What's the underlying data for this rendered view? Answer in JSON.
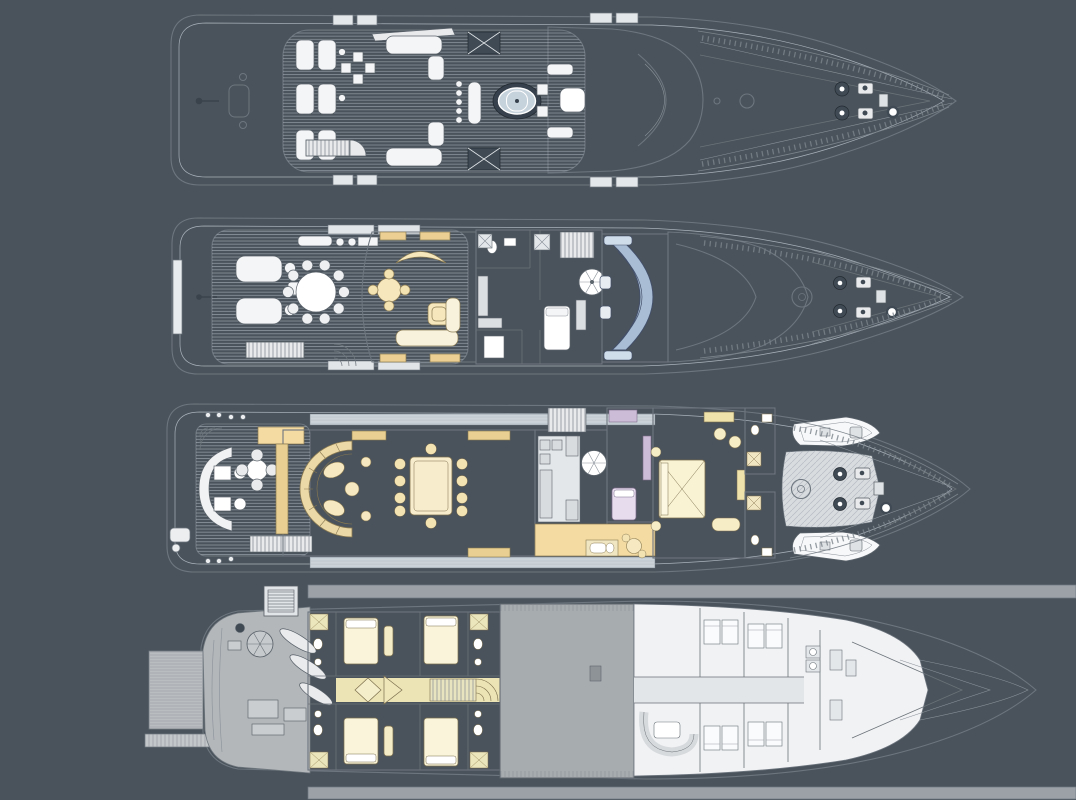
{
  "title": "yacht-general-arrangement-plans",
  "colors": {
    "background": "#4a525b",
    "outline": "#6d757e",
    "hull_white": "#fbfbfc",
    "teak_deck": "#ccd4da",
    "structure_gray": "#d9e0e6",
    "cream_deck": "#eae5d1",
    "salon_tan": "#f4dba2",
    "tan_dark": "#e9cf92",
    "cabin_yellow": "#f2ecc4",
    "master_yellow": "#f4eec2",
    "study_lavender": "#d8c9e1",
    "bridge_blue": "#bcd1e3",
    "console_blue": "#a9bed4",
    "spa_rim": "#36414d",
    "spa_water": "#c7d3dc",
    "engine_gray": "#a7acaf",
    "garage_gray": "#b3b7ba",
    "platform_gray": "#b9bdc0",
    "room_white": "#eef0f2",
    "furniture_white": "#f4f5f6",
    "equipment_dark": "#3f4a55"
  },
  "decks": [
    {
      "id": "sun-deck",
      "order": 1,
      "features": [
        "flag-staff",
        "deck-hatch",
        "sun-loungers",
        "occasional-tables",
        "crane-arm",
        "lounge-sofas",
        "mast-arch",
        "bar-counter",
        "bar-stools",
        "spa-pool",
        "aft-stairs",
        "forward-seating",
        "windscreen",
        "life-raft-boxes",
        "bow-capstan",
        "anchor-windlass",
        "mooring-cleats",
        "bow-rails"
      ]
    },
    {
      "id": "bridge-deck",
      "order": 2,
      "features": [
        "boarding-platform",
        "flag-staff",
        "sun-pads",
        "side-tables",
        "aft-settee",
        "alfresco-dining-table",
        "dining-chairs",
        "aft-stairs",
        "sky-lounge",
        "curved-settee",
        "games-table",
        "corner-table",
        "lounge-sofa",
        "day-head",
        "dumbwaiter",
        "pantry",
        "captain-cabin",
        "spiral-stairs",
        "wheelhouse",
        "helm-console",
        "helm-chairs",
        "portuguese-bridge",
        "mast-base",
        "anchor-windlass",
        "mooring-cleats",
        "bow-rails"
      ]
    },
    {
      "id": "main-deck",
      "order": 3,
      "features": [
        "stern-fittings",
        "fan-stairs",
        "curved-aft-sofa",
        "coffee-tables",
        "round-table",
        "deck-bar",
        "aft-stairs",
        "main-salon",
        "arc-sofa",
        "side-tables",
        "dining-table",
        "dining-chairs",
        "sideboards",
        "galley",
        "stairs-up",
        "spiral-stairs",
        "study",
        "single-berth",
        "day-bath",
        "lobby",
        "master-stateroom",
        "king-bed",
        "lounge-chairs",
        "his-hers-bathrooms",
        "tender-boats",
        "foredeck-hatch",
        "mast-base",
        "anchor-windlass",
        "bow-rails"
      ]
    },
    {
      "id": "lower-deck",
      "order": 4,
      "features": [
        "swim-platform",
        "transom-steps",
        "garage",
        "spiral-stairs",
        "exhaust-vent",
        "kayaks",
        "machinery",
        "guest-cabins",
        "guest-beds",
        "ensuite-bathrooms",
        "guest-lobby",
        "stairs-up",
        "engine-room",
        "crew-corridor",
        "crew-mess",
        "crew-cabins",
        "bunk-beds",
        "laundry",
        "bow-locker"
      ]
    }
  ]
}
